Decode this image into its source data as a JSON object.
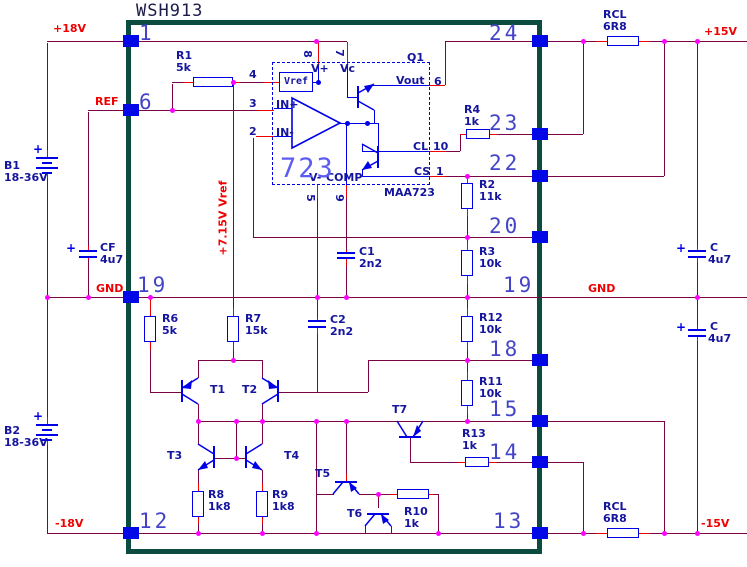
{
  "title": "WSH913",
  "rails": {
    "p18": "+18V",
    "ref": "REF",
    "gnd_l": "GND",
    "n18": "-18V",
    "p15": "+15V",
    "gnd_r": "GND",
    "n15": "-15V",
    "vref_rail": "+7.15V Vref"
  },
  "pins": {
    "l1": "1",
    "l6": "6",
    "l19": "19",
    "l12": "12",
    "r24": "24",
    "r23": "23",
    "r22": "22",
    "r20": "20",
    "r19": "19",
    "r18": "18",
    "r15": "15",
    "r14": "14",
    "r13": "13"
  },
  "ic": {
    "big": "723",
    "part": "MAA723",
    "q1": "Q1",
    "vref_box": "Vref",
    "vplus": "V+",
    "vc": "Vc",
    "inp": "IN+",
    "inn": "IN-",
    "vout": "Vout",
    "cl": "CL",
    "cs": "CS",
    "vminus": "V-",
    "comp": "COMP",
    "n8": "8",
    "n7": "7",
    "n4": "4",
    "n3": "3",
    "n2": "2",
    "n6": "6",
    "n10": "10",
    "n1": "1",
    "n5": "5",
    "n9": "9"
  },
  "parts": {
    "r1": [
      "R1",
      "5k"
    ],
    "r2": [
      "R2",
      "11k"
    ],
    "r3": [
      "R3",
      "10k"
    ],
    "r4": [
      "R4",
      "1k"
    ],
    "r6": [
      "R6",
      "5k"
    ],
    "r7": [
      "R7",
      "15k"
    ],
    "r8": [
      "R8",
      "1k8"
    ],
    "r9": [
      "R9",
      "1k8"
    ],
    "r10": [
      "R10",
      "1k"
    ],
    "r11": [
      "R11",
      "10k"
    ],
    "r12": [
      "R12",
      "10k"
    ],
    "r13": [
      "R13",
      "1k"
    ],
    "rcl_top": [
      "RCL",
      "6R8"
    ],
    "rcl_bottom": [
      "RCL",
      "6R8"
    ],
    "c1": [
      "C1",
      "2n2"
    ],
    "c2": [
      "C2",
      "2n2"
    ],
    "cf": [
      "CF",
      "4u7"
    ],
    "c_top_right": [
      "C",
      "4u7"
    ],
    "c_bottom_right": [
      "C",
      "4u7"
    ],
    "b1": [
      "B1",
      "18-36V"
    ],
    "b2": [
      "B2",
      "18-36V"
    ]
  },
  "transistors": {
    "t1": "T1",
    "t2": "T2",
    "t3": "T3",
    "t4": "T4",
    "t5": "T5",
    "t6": "T6",
    "t7": "T7"
  },
  "colors": {
    "wire": "#7A0445",
    "lead": "#F00000",
    "junction": "#FF00FF",
    "component": "#0000E8",
    "border": "#0C4B3F",
    "pin_number": "#4444C8"
  }
}
